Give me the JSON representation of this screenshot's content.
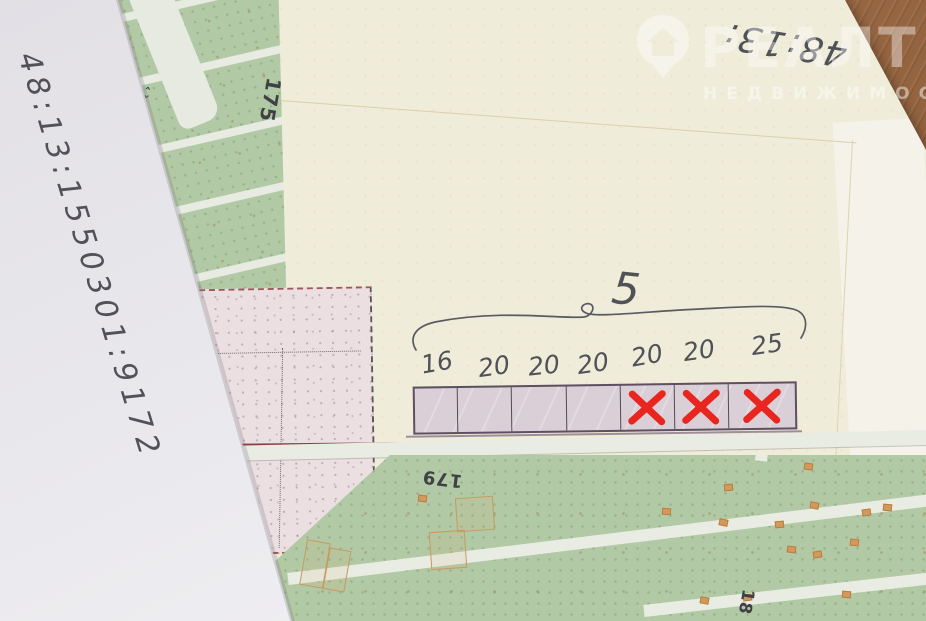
{
  "photo": {
    "left_sheet": {
      "handwritten_number": "48:13:1550301:9172"
    },
    "top_annotation": {
      "handwritten_number": "48:13:"
    },
    "watermark": {
      "brand": "РЕАЛТ",
      "tagline": "НЕДВИЖИМОСТЬ",
      "icon": "house-location-pin-icon"
    },
    "plot_group": {
      "count_label": "5",
      "cells": [
        {
          "width_label": "16",
          "crossed": false
        },
        {
          "width_label": "20",
          "crossed": false
        },
        {
          "width_label": "20",
          "crossed": false
        },
        {
          "width_label": "20",
          "crossed": false
        },
        {
          "width_label": "20",
          "crossed": true
        },
        {
          "width_label": "20",
          "crossed": true
        },
        {
          "width_label": "25",
          "crossed": true
        }
      ]
    },
    "map_labels": {
      "upper_parcel": "175",
      "lower_parcel": "179",
      "lower_right_parcel": "18",
      "road_mark": "‹ ›"
    },
    "colors": {
      "cross_red": "#e8251f",
      "pencil_gray": "#515258",
      "map_green": "#b2c9a5",
      "strip_fill": "#dacfd7",
      "strip_border": "#5e5060",
      "desk_wood": "#9d6c46"
    }
  }
}
